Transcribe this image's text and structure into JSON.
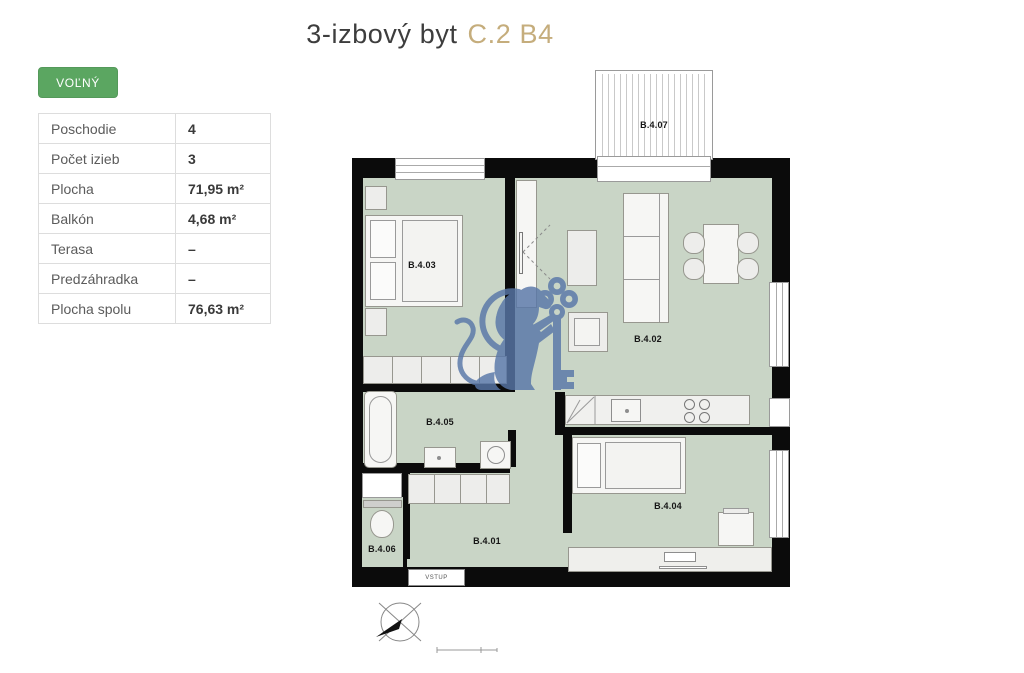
{
  "header": {
    "title_main": "3-izbový byt",
    "title_unit": "C.2 B4"
  },
  "availability": {
    "label": "VOĽNÝ",
    "color": "#5ba661"
  },
  "details": {
    "rows": [
      {
        "label": "Poschodie",
        "value": "4"
      },
      {
        "label": "Počet izieb",
        "value": "3"
      },
      {
        "label": "Plocha",
        "value": "71,95 m²"
      },
      {
        "label": "Balkón",
        "value": "4,68 m²"
      },
      {
        "label": "Terasa",
        "value": "–"
      },
      {
        "label": "Predzáhradka",
        "value": "–"
      },
      {
        "label": "Plocha spolu",
        "value": "76,63 m²"
      }
    ]
  },
  "floorplan": {
    "rooms": [
      {
        "id": "B.4.01"
      },
      {
        "id": "B.4.02"
      },
      {
        "id": "B.4.03"
      },
      {
        "id": "B.4.04"
      },
      {
        "id": "B.4.05"
      },
      {
        "id": "B.4.06"
      },
      {
        "id": "B.4.07"
      }
    ],
    "entrance_label": "VSTUP",
    "icons": {
      "watermark": "lion-with-key",
      "compass": "north-arrow",
      "scale": "scale-bar"
    },
    "colors": {
      "floor": "#c9d5c6",
      "wall": "#0b0b0b",
      "furniture": "#ededeb",
      "watermark_blue": "#5877a8",
      "title_accent": "#c5ad7c",
      "status_green": "#5ba661"
    }
  }
}
